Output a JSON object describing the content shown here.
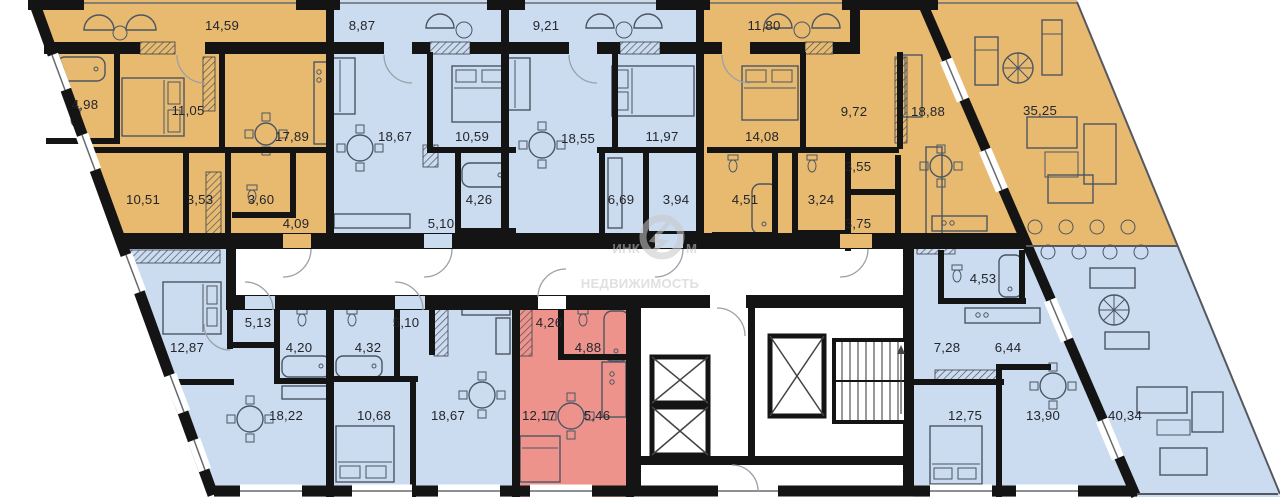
{
  "colors": {
    "unit_orange": "#e8ba70",
    "unit_blue": "#cbdcf1",
    "unit_red": "#ee938c",
    "wall": "#141414"
  },
  "watermark": {
    "brand_left": "ИНК",
    "brand_right": "М",
    "subtitle": "НЕДВИЖИМОСТЬ"
  },
  "areas": {
    "u1_balcony": "14,59",
    "u1_bath": "4,98",
    "u1_bedroom": "11,05",
    "u1_living": "17,89",
    "u1_room": "10,51",
    "u1_hall": "3,53",
    "u1_wc": "3,60",
    "u1_entry": "4,09",
    "u2_balcony": "8,87",
    "u2_living": "18,67",
    "u2_bedroom": "10,59",
    "u2_bath": "4,26",
    "u2_hall": "5,10",
    "u3_balcony": "9,21",
    "u3_living": "18,55",
    "u3_bedroom": "11,97",
    "u3_kitchen": "6,69",
    "u3_bath": "3,94",
    "u4_balcony": "11,80",
    "u4_bedroom": "14,08",
    "u4_room": "9,72",
    "u4_living": "18,88",
    "u4_hall": "3,55",
    "u4_bath1": "4,51",
    "u4_bath2": "3,24",
    "u4_hall2": "3,75",
    "u4_terrace": "35,25",
    "u5_bedroom": "12,87",
    "u5_hall": "5,13",
    "u5_bath": "4,20",
    "u5_living": "18,22",
    "u6_bath": "4,32",
    "u6_hall": "5,10",
    "u6_bedroom": "10,68",
    "u6_living": "18,67",
    "u7_entry": "4,26",
    "u7_bath": "4,88",
    "u7_room": "12,17",
    "u7_kitchen": "5,46",
    "u8_bath": "4,53",
    "u8_hall": "7,28",
    "u8_kitchen": "6,44",
    "u8_bedroom": "12,75",
    "u8_living": "13,90",
    "u8_terrace": "40,34"
  }
}
